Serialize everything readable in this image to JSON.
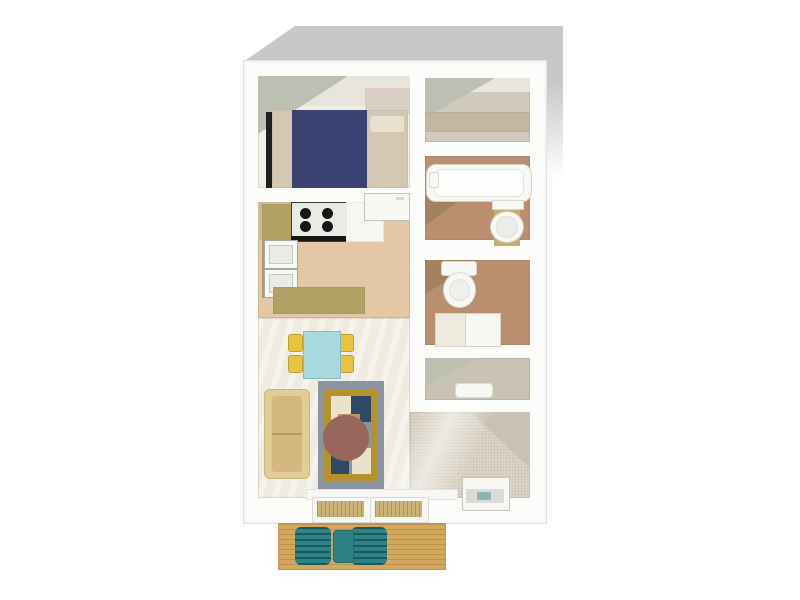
{
  "scene": {
    "type": "3d-floorplan-render",
    "view": "top-down perspective",
    "background": "#ffffff",
    "shadow": "#c8c8c8"
  },
  "rooms": [
    {
      "id": "bedroom",
      "furniture": [
        "double-bed"
      ]
    },
    {
      "id": "closet-upper",
      "furniture": [
        "shelf"
      ]
    },
    {
      "id": "bathroom",
      "furniture": [
        "bathtub",
        "sink-vanity"
      ]
    },
    {
      "id": "wc",
      "furniture": [
        "toilet",
        "storage-cabinet"
      ]
    },
    {
      "id": "closet-lower",
      "furniture": [
        "shelf",
        "floor-item"
      ]
    },
    {
      "id": "kitchen",
      "furniture": [
        "stove",
        "oven-stack",
        "refrigerator",
        "counter",
        "peninsula-counter"
      ]
    },
    {
      "id": "dining-area",
      "furniture": [
        "dining-table",
        "chair",
        "chair",
        "chair",
        "chair"
      ]
    },
    {
      "id": "living-room",
      "furniture": [
        "sofa",
        "area-rug",
        "floor-unit",
        "sliding-doors"
      ]
    },
    {
      "id": "balcony",
      "furniture": [
        "patio-chair",
        "patio-chair",
        "patio-table",
        "wood-deck"
      ]
    }
  ],
  "palette": {
    "wall": "#fcfcfb",
    "shadow": "#c8c8c8",
    "wall_shade": "#bdbfb2",
    "wall_shade_warm": "#cdbb95",
    "wall_shade_brown": "#a3805f",
    "band_light": "#e7e5dc",
    "bedroom_floor": "#f1eee6",
    "bedroom_floor_accent": "#d9cfc4",
    "bed_mattress": "#d5c8b2",
    "bed_pillow": "#e8e1d2",
    "bed_duvet": "#3b4170",
    "bed_headboard": "#1f1f1f",
    "closet_floor": "#cfcaba",
    "closet_shelf": "#c3b7a3",
    "closet_floor_lower": "#c9c3b3",
    "bath_floor": "#ba8f6f",
    "fixture_white": "#f7f7f4",
    "fixture_inner": "#ebebe6",
    "vanity_gold": "#c8ae66",
    "cabinet_cream": "#efeade",
    "kitchen_floor": "#e4c8a5",
    "counter_khaki": "#b2a165",
    "stove_dark": "#161616",
    "living_floor": "#f0ebe1",
    "carpet": "#dcd4c6",
    "carpet_shade": "#c9c1b3",
    "table_cyan": "#a9d9dd",
    "chair_yellow": "#e8c43e",
    "sofa_frame": "#e2cd97",
    "sofa_seat": "#d5b87e",
    "rug_border": "#8b94a1",
    "rug_gold": "#b8912f",
    "rug_navy": "#2c4a68",
    "rug_cream": "#e9e2cc",
    "rug_teal": "#2e6e72",
    "rug_tan": "#c1935a",
    "rug_circle": "#98675c",
    "threshold": "#cbb37a",
    "deck": "#d2a75e",
    "patio_teal": "#2e8286",
    "appliance_band": "#dcdcd6",
    "appliance_teal": "#8fb4b6"
  }
}
